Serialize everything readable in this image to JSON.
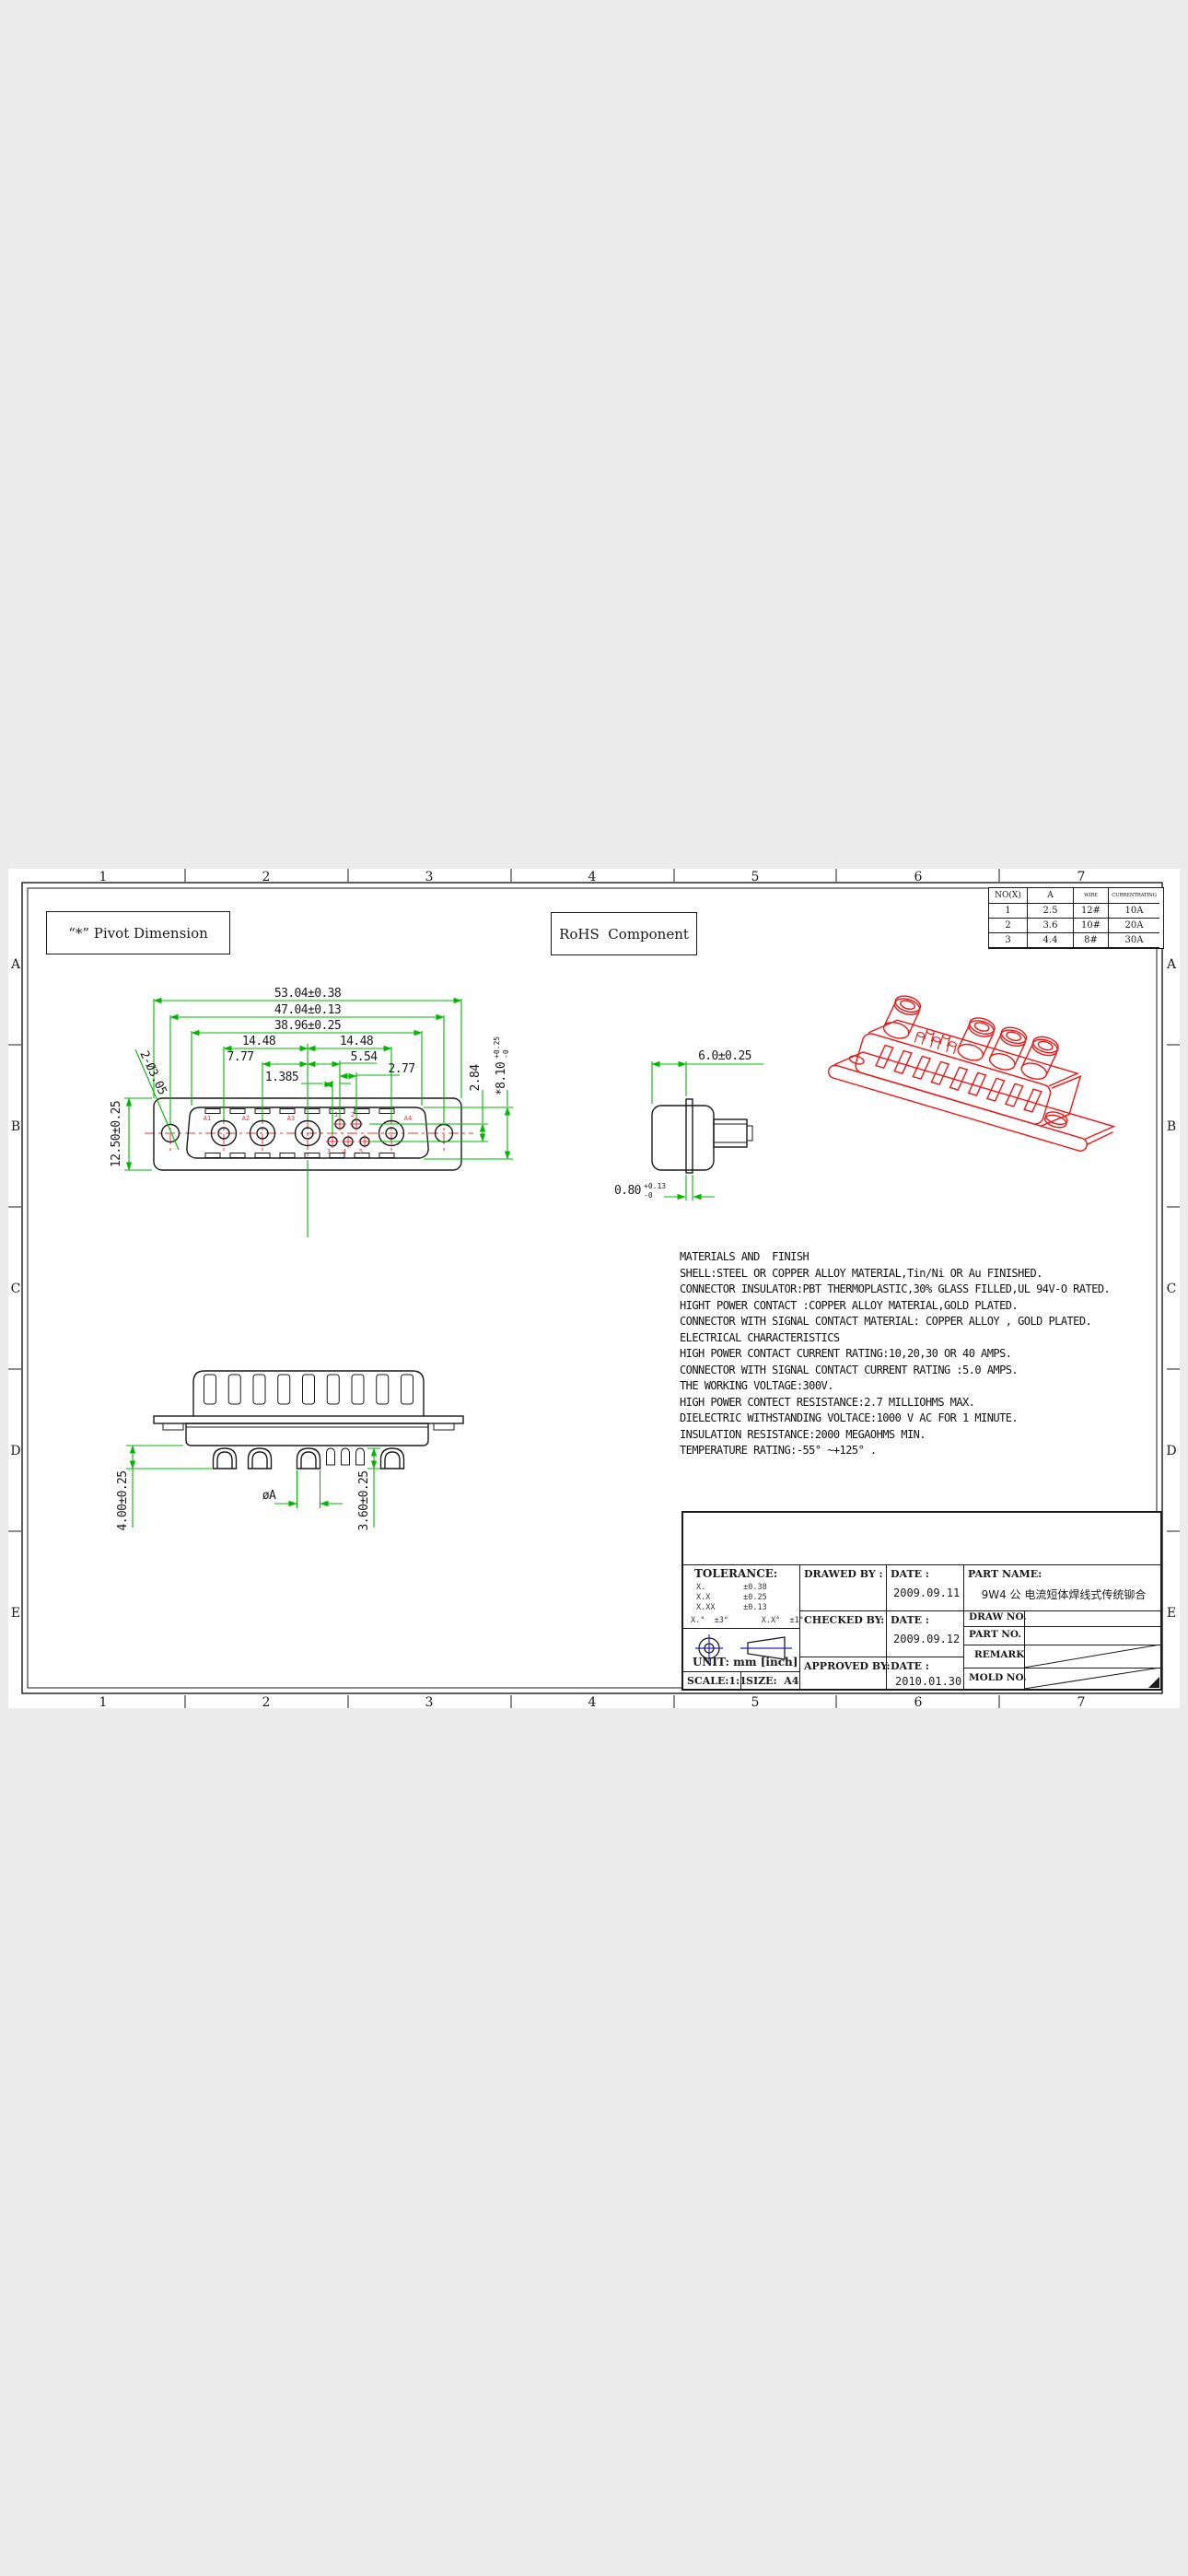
{
  "annotations": {
    "pivot": "“*” Pivot Dimension",
    "rohs": "RoHS  Component"
  },
  "zones": {
    "columns": [
      "1",
      "2",
      "3",
      "4",
      "5",
      "6",
      "7"
    ],
    "rows": [
      "A",
      "B",
      "C",
      "D",
      "E"
    ]
  },
  "rating_table": {
    "headers": [
      "NO(X)",
      "A",
      "WIRE",
      "CURRENTRATING"
    ],
    "rows": [
      [
        "1",
        "2.5",
        "12#",
        "10A"
      ],
      [
        "2",
        "3.6",
        "10#",
        "20A"
      ],
      [
        "3",
        "4.4",
        "8#",
        "30A"
      ]
    ]
  },
  "front_view": {
    "dim_53": "53.04±0.38",
    "dim_47": "47.04±0.13",
    "dim_39": "38.96±0.25",
    "dim_1448L": "14.48",
    "dim_1448R": "14.48",
    "dim_777": "7.77",
    "dim_554": "5.54",
    "dim_277": "2.77",
    "dim_1385": "1.385",
    "dim_125": "12.50±0.25",
    "dim_284": "2.84",
    "dim_810_main": "*8.10",
    "dim_810_sup": "+0.25",
    "dim_810_sub": "-0",
    "leader": "2-Ø3.05",
    "contact_labels": {
      "a1": "A1",
      "a2": "A2",
      "a3": "A3",
      "a4": "A4"
    },
    "pin_labels": {
      "p1": "1",
      "p2": "2",
      "p3": "3",
      "p4": "4",
      "p5": "5"
    }
  },
  "side_view": {
    "dim_60": "6.0±0.25",
    "dim_080_main": "0.80",
    "dim_080_sup": "+0.13",
    "dim_080_sub": "-0"
  },
  "bottom_view": {
    "dim_400": "4.00±0.25",
    "dim_360": "3.60±0.25",
    "dim_dia": "øA"
  },
  "notes": {
    "lines": [
      "MATERIALS AND  FINISH",
      "SHELL:STEEL OR COPPER ALLOY MATERIAL,Tin/Ni OR Au FINISHED.",
      "CONNECTOR INSULATOR:PBT THERMOPLASTIC,30% GLASS FILLED,UL 94V-O RATED.",
      "HIGHT POWER CONTACT :COPPER ALLOY MATERIAL,GOLD PLATED.",
      "CONNECTOR WITH SIGNAL CONTACT MATERIAL: COPPER ALLOY , GOLD PLATED.",
      "ELECTRICAL CHARACTERISTICS",
      "HIGH POWER CONTACT CURRENT RATING:10,20,30 OR 40 AMPS.",
      "CONNECTOR WITH SIGNAL CONTACT CURRENT RATING :5.0 AMPS.",
      "THE WORKING VOLTAGE:300V.",
      "HIGH POWER CONTECT RESISTANCE:2.7 MILLIOHMS MAX.",
      "DIELECTRIC WITHSTANDING VOLTACE:1000 V AC FOR 1 MINUTE.",
      "INSULATION RESISTANCE:2000 MEGAOHMS MIN.",
      "TEMPERATURE RATING:-55° ~+125° ."
    ]
  },
  "title_block": {
    "tolerance_title": "TOLERANCE:",
    "tolerance_rows": [
      "X.        ±0.38",
      "X.X       ±0.25",
      "X.XX      ±0.13"
    ],
    "tolerance_angles": "X.°  ±3°       X.X°  ±1°",
    "unit": "UNIT: mm [inch]",
    "scale": "SCALE:1:1",
    "size": "SIZE:  A4",
    "drawn_label": "DRAWED BY :",
    "checked_label": "CHECKED BY:",
    "approved_label": "APPROVED BY:",
    "date_label": "DATE :",
    "drawn_date": "2009.09.11",
    "checked_date": "2009.09.12",
    "approved_date": "2010.01.30",
    "part_name_label": "PART NAME:",
    "part_name": "9W4 公 电流短体焊线式传统铆合",
    "field_draw_no": "DRAW NO.",
    "field_part_no": "PART NO.",
    "field_remark": "REMARK",
    "field_mold_no": "MOLD NO."
  },
  "colors": {
    "dimension_green": "#00b800",
    "centerline_red": "#f23030",
    "iso_red": "#ee1515",
    "symbol_blue": "#2222cc",
    "background_gray": "#ececec"
  }
}
